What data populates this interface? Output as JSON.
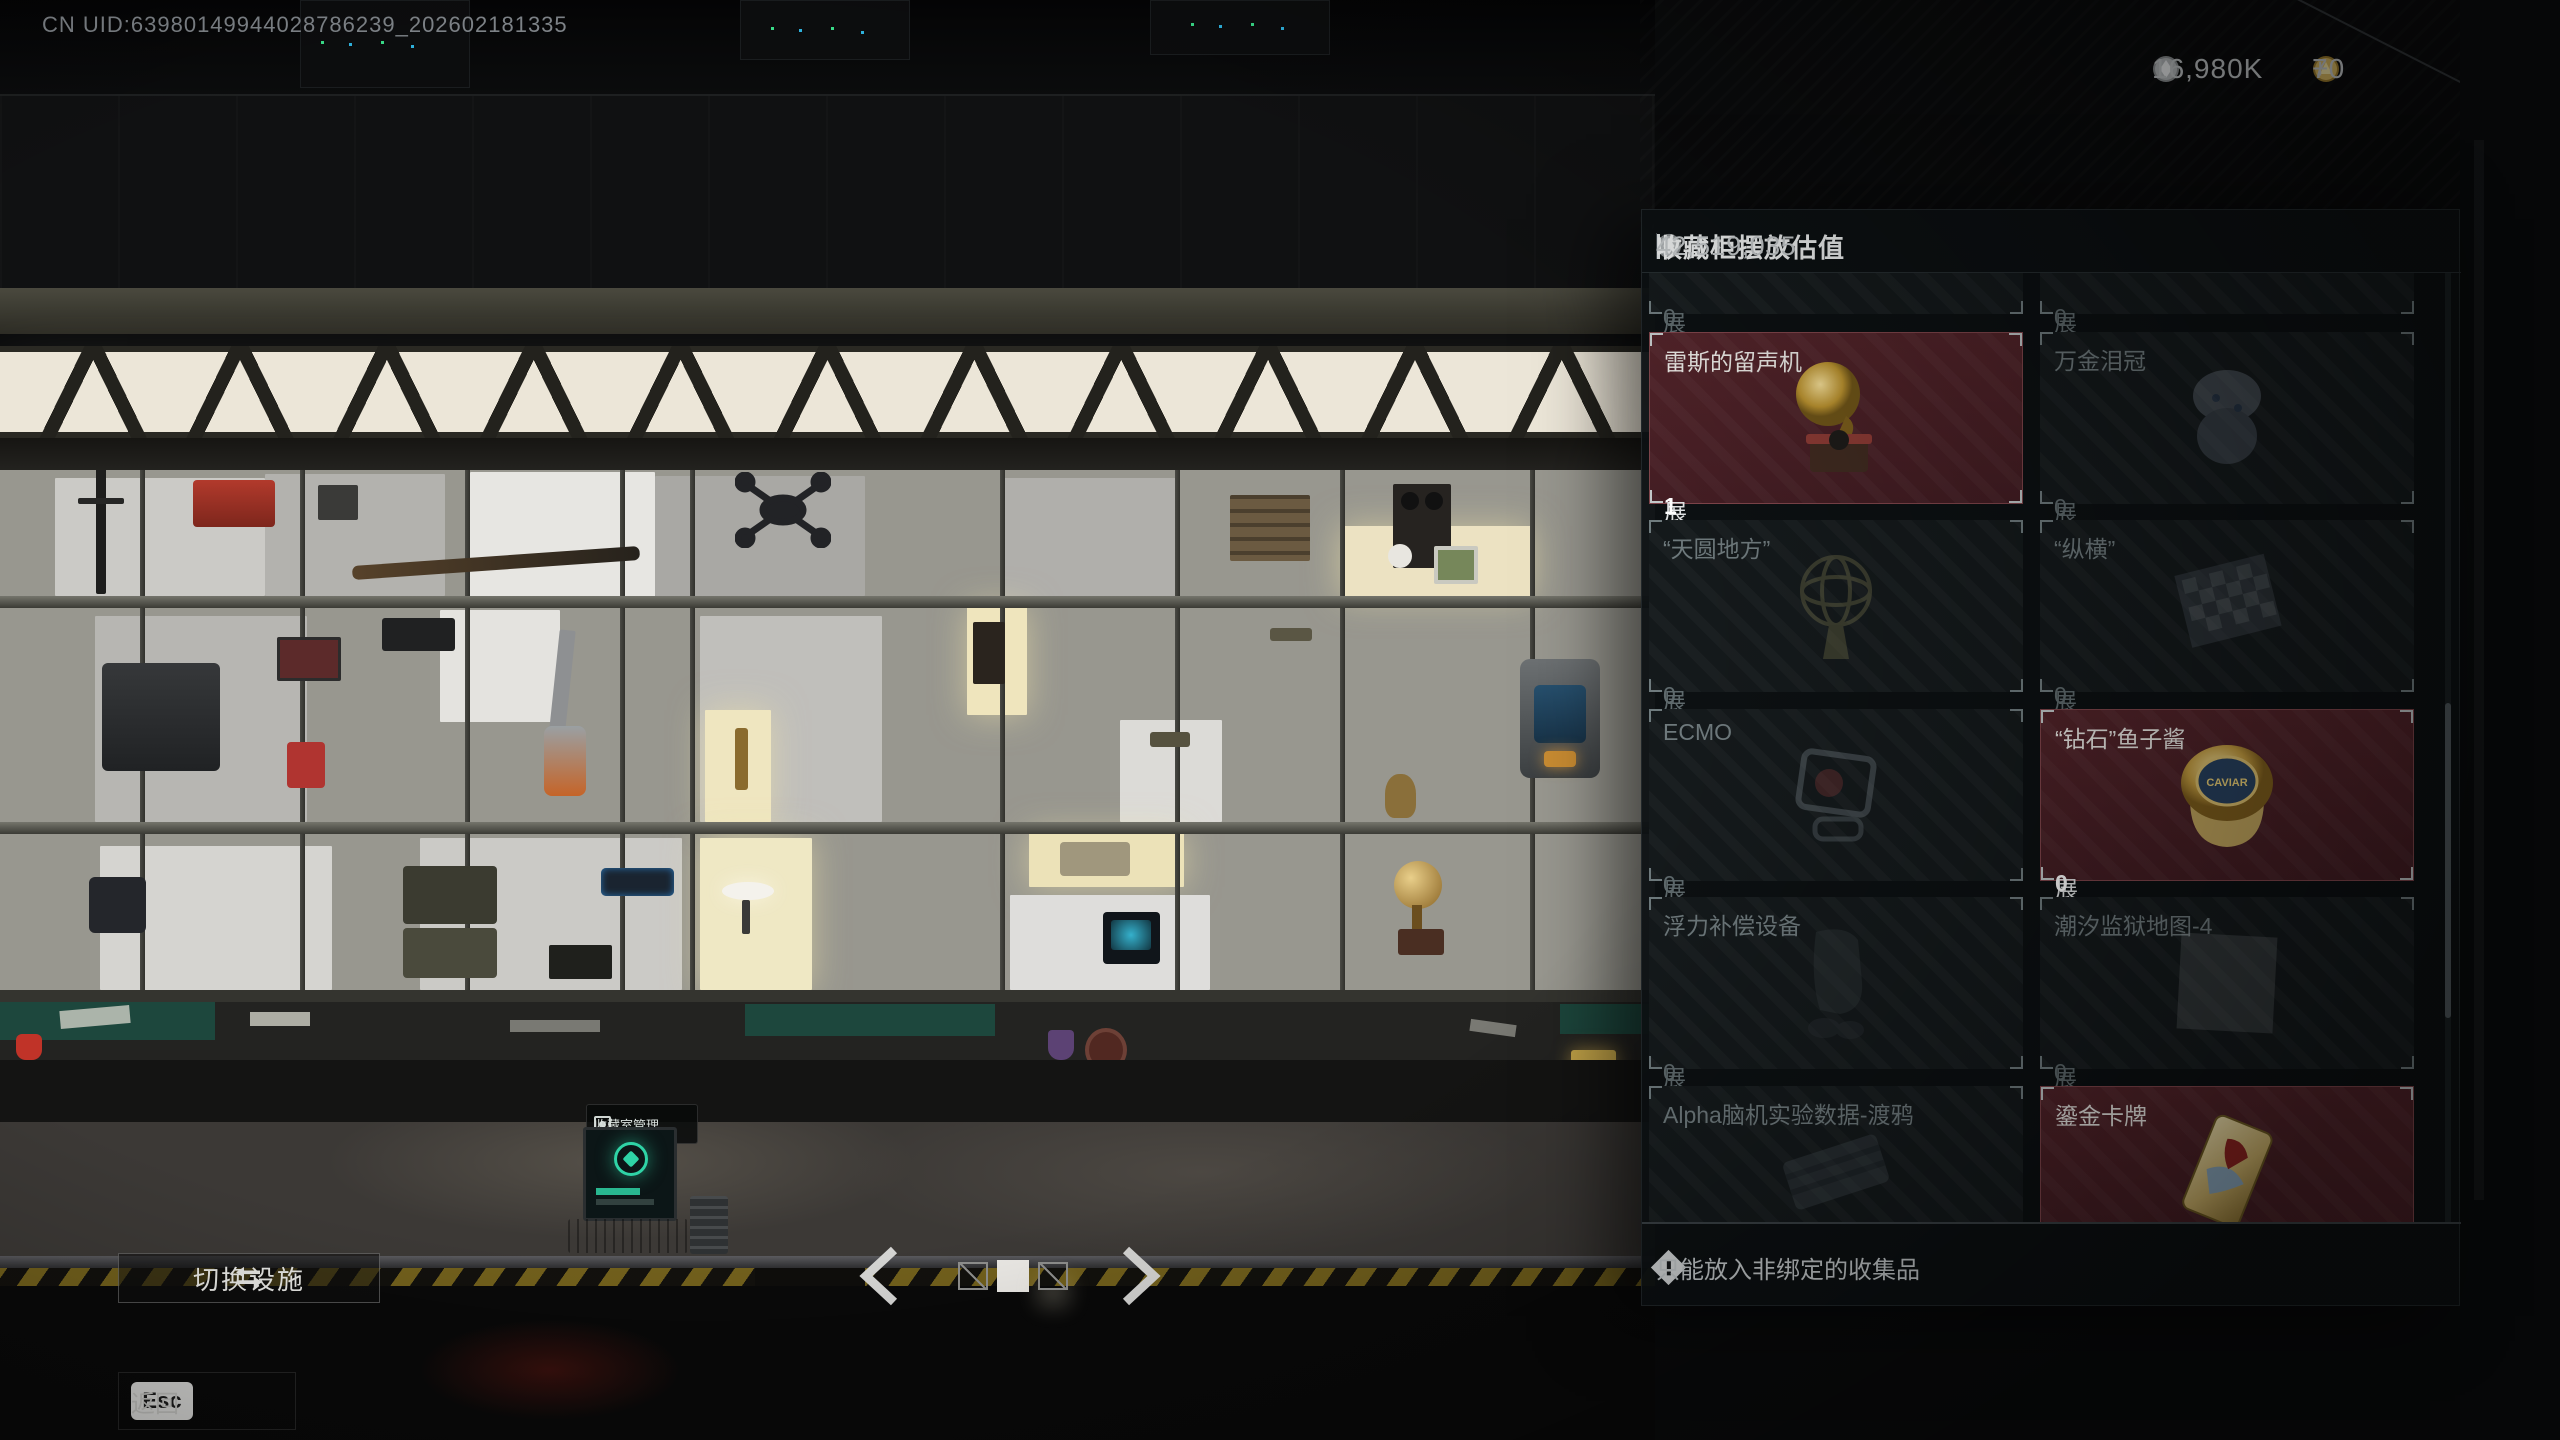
{
  "theme": {
    "card_highlight_bg": "#4b2026",
    "card_highlight_border": "#7e444a",
    "card_dim_bg": "#14191b",
    "bracket_bright": "#c2c8c9",
    "bracket_dim": "#6f7b7e",
    "silver": "#c9cdcf",
    "gold": "#cda54c",
    "hazard": "#8c7520",
    "screen_green": "#2fd3a6"
  },
  "header": {
    "uid": "CN UID:63980149944028786239_202602181335",
    "silver_amount": "16,980K",
    "gold_amount": "70",
    "gold_add": "+"
  },
  "panel": {
    "title": "收藏柜摆放估值",
    "total_value": "42,519,035",
    "level_label": "展位等级:",
    "footer_note": "只能放入非绑定的收集品",
    "caviar_art_label": "CAVIAR",
    "cards": [
      {
        "name": "",
        "level": "0"
      },
      {
        "name": "",
        "level": "0"
      },
      {
        "name": "雷斯的留声机",
        "level": "1"
      },
      {
        "name": "万金泪冠",
        "level": "0"
      },
      {
        "name": "“天圆地方”",
        "level": "0"
      },
      {
        "name": "“纵横”",
        "level": "0"
      },
      {
        "name": "ECMO",
        "level": "0"
      },
      {
        "name": "“钻石”鱼子酱",
        "level": "0"
      },
      {
        "name": "浮力补偿设备",
        "level": "0"
      },
      {
        "name": "潮汐监狱地图-4",
        "level": "0"
      },
      {
        "name": "Alpha脑机实验数据-渡鸦",
        "level": ""
      },
      {
        "name": "鎏金卡牌",
        "level": ""
      }
    ]
  },
  "scene": {
    "switch_facility": "切换设施",
    "esc_key": "Esc",
    "esc_back": "返回",
    "laptop_label": "收藏室管理"
  }
}
